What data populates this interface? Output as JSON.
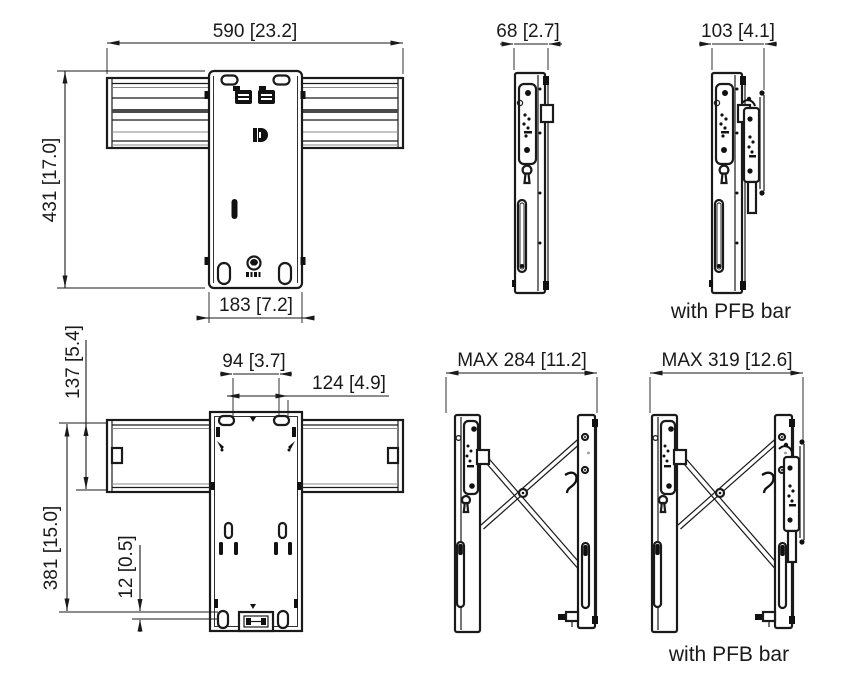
{
  "page": {
    "background_color": "#ffffff",
    "line_color": "#1a1a1a"
  },
  "captions": {
    "with_pfb_bar_top": "with PFB bar",
    "with_pfb_bar_bottom": "with PFB bar"
  },
  "dimensions": {
    "front_width": "590 [23.2]",
    "front_height": "431 [17.0]",
    "front_plate_width": "183 [7.2]",
    "side_depth": "68 [2.7]",
    "side_pfb_depth": "103 [4.1]",
    "back_rail_height": "137 [5.4]",
    "back_hole_span_inner": "94 [3.7]",
    "back_hole_span_outer": "124 [4.9]",
    "back_height": "381 [15.0]",
    "back_bottom_offset": "12 [0.5]",
    "extended_max_depth": "MAX 284 [11.2]",
    "extended_pfb_max_depth": "MAX 319 [12.6]"
  }
}
